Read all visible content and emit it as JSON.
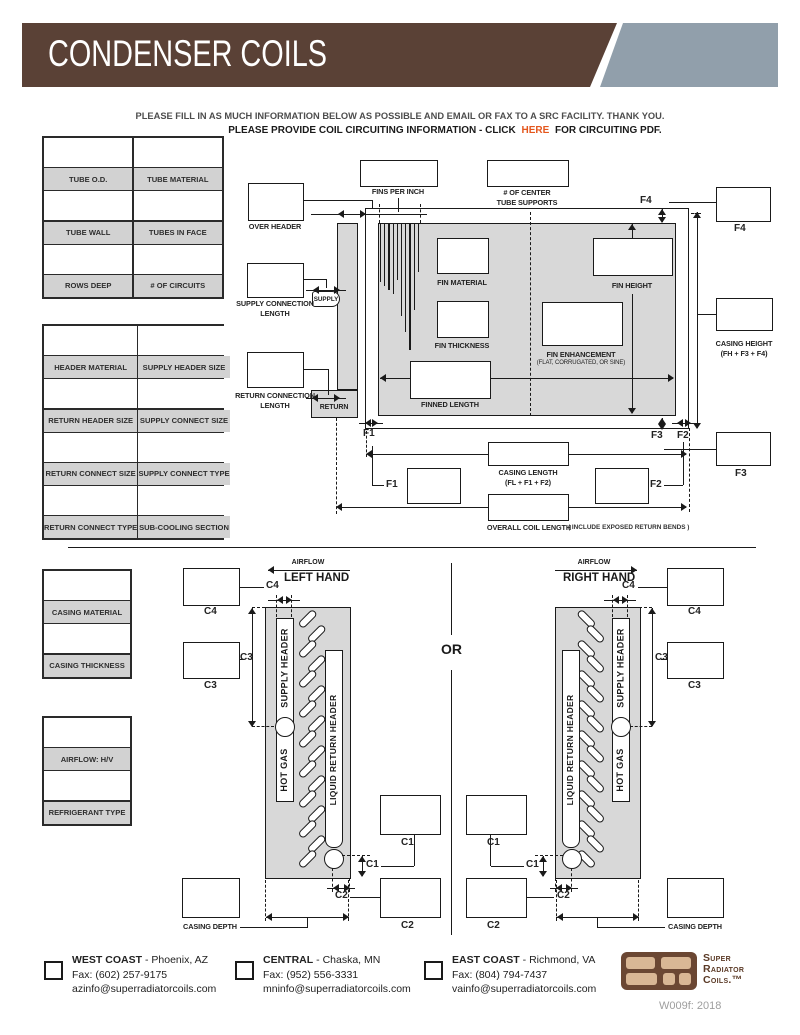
{
  "header": {
    "title": "CONDENSER COILS",
    "banner_color": "#5a4136",
    "accent_color": "#919fab"
  },
  "intro": {
    "line1": "PLEASE FILL IN AS MUCH INFORMATION BELOW AS POSSIBLE AND EMAIL OR FAX TO A SRC FACILITY. THANK YOU.",
    "line2_prefix": "PLEASE PROVIDE COIL CIRCUITING INFORMATION - CLICK",
    "line2_link": "HERE",
    "line2_suffix": "FOR CIRCUITING PDF.",
    "link_color": "#e4571d"
  },
  "tables": {
    "t1": [
      "TUBE O.D.",
      "TUBE MATERIAL",
      "TUBE WALL",
      "TUBES IN FACE",
      "ROWS DEEP",
      "# OF CIRCUITS"
    ],
    "t2": [
      "HEADER MATERIAL",
      "SUPPLY HEADER SIZE",
      "RETURN HEADER SIZE",
      "SUPPLY CONNECT SIZE",
      "RETURN CONNECT SIZE",
      "SUPPLY CONNECT TYPE",
      "RETURN CONNECT TYPE",
      "SUB-COOLING SECTION"
    ],
    "t3": [
      "CASING MATERIAL",
      "CASING THICKNESS"
    ],
    "t4": [
      "AIRFLOW: H/V",
      "REFRIGERANT TYPE"
    ]
  },
  "diagram": {
    "fins_per_inch": "FINS PER INCH",
    "center_supports_1": "# OF CENTER",
    "center_supports_2": "TUBE SUPPORTS",
    "over_header": "OVER HEADER",
    "supply_tag": "SUPPLY",
    "return_tag": "RETURN",
    "supply_conn_1": "SUPPLY CONNECTION",
    "supply_conn_2": "LENGTH",
    "return_conn_1": "RETURN CONNECTION",
    "return_conn_2": "LENGTH",
    "fin_material": "FIN MATERIAL",
    "fin_height": "FIN HEIGHT",
    "fin_thickness": "FIN THICKNESS",
    "fin_enhancement": "FIN ENHANCEMENT",
    "fin_enhancement_sub": "(FLAT, CORRUGATED, OR SINE)",
    "finned_length": "FINNED LENGTH",
    "casing_height_1": "CASING HEIGHT",
    "casing_height_2": "(FH + F3 + F4)",
    "casing_length_1": "CASING LENGTH",
    "casing_length_2": "(FL + F1 + F2)",
    "overall_length": "OVERALL COIL LENGTH",
    "overall_note": "( INCLUDE EXPOSED RETURN BENDS )",
    "f1": "F1",
    "f2": "F2",
    "f3": "F3",
    "f4": "F4"
  },
  "coils": {
    "airflow": "AIRFLOW",
    "left_hand": "LEFT HAND",
    "right_hand": "RIGHT HAND",
    "or": "OR",
    "supply_header": "SUPPLY HEADER",
    "hot_gas": "HOT GAS",
    "liquid_return_header": "LIQUID RETURN HEADER",
    "c1": "C1",
    "c2": "C2",
    "c3": "C3",
    "c4": "C4",
    "casing_depth": "CASING DEPTH"
  },
  "footer": {
    "locations": [
      {
        "region": "WEST COAST",
        "city": "- Phoenix, AZ",
        "fax": "Fax: (602) 257-9175",
        "email": "azinfo@superradiatorcoils.com"
      },
      {
        "region": "CENTRAL",
        "city": "- Chaska, MN",
        "fax": "Fax: (952) 556-3331",
        "email": "mninfo@superradiatorcoils.com"
      },
      {
        "region": "EAST COAST",
        "city": "- Richmond, VA",
        "fax": "Fax: (804) 794-7437",
        "email": "vainfo@superradiatorcoils.com"
      }
    ],
    "logo_1": "Super",
    "logo_2": "Radiator",
    "logo_3": "Coils.™",
    "doc_code": "W009f: 2018"
  }
}
